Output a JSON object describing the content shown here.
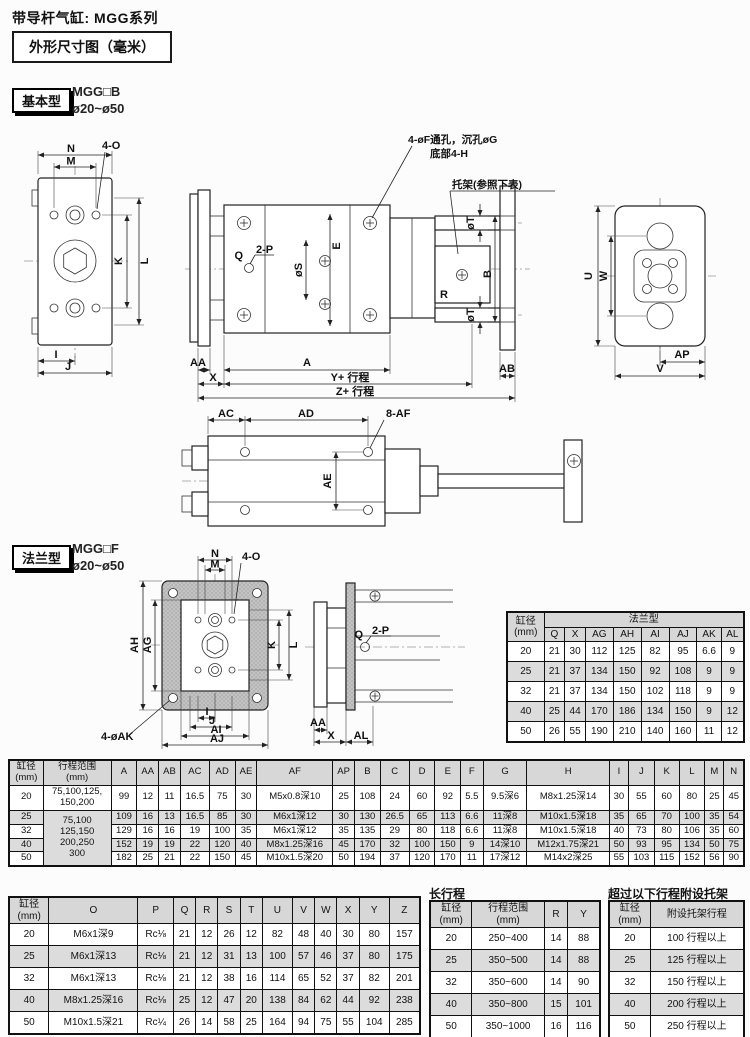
{
  "page": {
    "title": "带导杆气缸: MGG系列",
    "dim_box": "外形尺寸图（毫米）"
  },
  "basic": {
    "tag": "基本型",
    "model": "MGG□B",
    "bore": "ø20~ø50"
  },
  "flange": {
    "tag": "法兰型",
    "model": "MGG□F",
    "bore": "ø20~ø50"
  },
  "basic_labels": {
    "N": "N",
    "M": "M",
    "fourO": "4-O",
    "K": "K",
    "L": "L",
    "I": "I",
    "J": "J",
    "C": "C",
    "D": "D",
    "holeNote1": "4-øF通孔，沉孔øG",
    "holeNote2": "底部4-H",
    "bracketNote": "托架(参照下表)",
    "Q": "Q",
    "twoP": "2-P",
    "phiS": "øS",
    "E": "E",
    "phiT": "øT",
    "B": "B",
    "R": "R",
    "AA": "AA",
    "X": "X",
    "A": "A",
    "Ystroke": "Y+ 行程",
    "Zstroke": "Z+ 行程",
    "AB": "AB",
    "U": "U",
    "W": "W",
    "AP": "AP",
    "V": "V",
    "AC": "AC",
    "AD": "AD",
    "eightAF": "8-AF",
    "AE": "AE"
  },
  "flange_labels": {
    "N": "N",
    "M": "M",
    "fourO": "4-O",
    "AH": "AH",
    "AG": "AG",
    "K": "K",
    "L": "L",
    "I": "I",
    "J": "J",
    "AI": "AI",
    "AJ": "AJ",
    "fourAK": "4-øAK",
    "Q": "Q",
    "twoP": "2-P",
    "AA": "AA",
    "X": "X",
    "AL": "AL"
  },
  "flange_table": {
    "header_rows": [
      [
        {
          "text": "缸径\n(mm)",
          "rowspan": 2
        },
        {
          "text": "法兰型",
          "colspan": 8
        }
      ],
      [
        "Q",
        "X",
        "AG",
        "AH",
        "AI",
        "AJ",
        "AK",
        "AL"
      ]
    ],
    "rows": [
      [
        "20",
        "21",
        "30",
        "112",
        "125",
        "82",
        "95",
        "6.6",
        "9"
      ],
      [
        "25",
        "21",
        "37",
        "134",
        "150",
        "92",
        "108",
        "9",
        "9"
      ],
      [
        "32",
        "21",
        "37",
        "134",
        "150",
        "102",
        "118",
        "9",
        "9"
      ],
      [
        "40",
        "25",
        "44",
        "170",
        "186",
        "134",
        "150",
        "9",
        "12"
      ],
      [
        "50",
        "26",
        "55",
        "190",
        "210",
        "140",
        "160",
        "11",
        "12"
      ]
    ]
  },
  "main_table": {
    "header_rows": [
      [
        "缸径\n(mm)",
        "行程范围\n(mm)",
        "A",
        "AA",
        "AB",
        "AC",
        "AD",
        "AE",
        "AF",
        "AP",
        "B",
        "C",
        "D",
        "E",
        "F",
        "G",
        "H",
        "I",
        "J",
        "K",
        "L",
        "M",
        "N"
      ]
    ],
    "rows": [
      [
        "20",
        "75,100,125,\n150,200",
        "99",
        "12",
        "11",
        "16.5",
        "75",
        "30",
        "M5x0.8深10",
        "25",
        "108",
        "24",
        "60",
        "92",
        "5.5",
        "9.5深6",
        "M8x1.25深14",
        "30",
        "55",
        "60",
        "80",
        "25",
        "45"
      ],
      [
        "25",
        {
          "text": "75,100\n125,150\n200,250\n300",
          "rowspan": 4
        },
        "109",
        "16",
        "13",
        "16.5",
        "85",
        "30",
        "M6x1深12",
        "30",
        "130",
        "26.5",
        "65",
        "113",
        "6.6",
        "11深8",
        "M10x1.5深18",
        "35",
        "65",
        "70",
        "100",
        "35",
        "54"
      ],
      [
        "32",
        null,
        "129",
        "16",
        "16",
        "19",
        "100",
        "35",
        "M6x1深12",
        "35",
        "135",
        "29",
        "80",
        "118",
        "6.6",
        "11深8",
        "M10x1.5深18",
        "40",
        "73",
        "80",
        "106",
        "35",
        "60"
      ],
      [
        "40",
        null,
        "152",
        "19",
        "19",
        "22",
        "120",
        "40",
        "M8x1.25深16",
        "45",
        "170",
        "32",
        "100",
        "150",
        "9",
        "14深10",
        "M12x1.75深21",
        "50",
        "93",
        "95",
        "134",
        "50",
        "75"
      ],
      [
        "50",
        null,
        "182",
        "25",
        "21",
        "22",
        "150",
        "45",
        "M10x1.5深20",
        "50",
        "194",
        "37",
        "120",
        "170",
        "11",
        "17深12",
        "M14x2深25",
        "55",
        "103",
        "115",
        "152",
        "56",
        "90"
      ]
    ]
  },
  "dims_table": {
    "header_rows": [
      [
        "缸径\n(mm)",
        "O",
        "P",
        "Q",
        "R",
        "S",
        "T",
        "U",
        "V",
        "W",
        "X",
        "Y",
        "Z"
      ]
    ],
    "rows": [
      [
        "20",
        "M6x1深9",
        "Rc⅛",
        "21",
        "12",
        "26",
        "12",
        "82",
        "48",
        "40",
        "30",
        "80",
        "157"
      ],
      [
        "25",
        "M6x1深13",
        "Rc⅛",
        "21",
        "12",
        "31",
        "13",
        "100",
        "57",
        "46",
        "37",
        "80",
        "175"
      ],
      [
        "32",
        "M6x1深13",
        "Rc⅛",
        "21",
        "12",
        "38",
        "16",
        "114",
        "65",
        "52",
        "37",
        "82",
        "201"
      ],
      [
        "40",
        "M8x1.25深16",
        "Rc⅛",
        "25",
        "12",
        "47",
        "20",
        "138",
        "84",
        "62",
        "44",
        "92",
        "238"
      ],
      [
        "50",
        "M10x1.5深21",
        "Rc¼",
        "26",
        "14",
        "58",
        "25",
        "164",
        "94",
        "75",
        "55",
        "104",
        "285"
      ]
    ]
  },
  "long_stroke": {
    "title": "长行程",
    "header_rows": [
      [
        "缸径\n(mm)",
        "行程范围\n(mm)",
        "R",
        "Y"
      ]
    ],
    "rows": [
      [
        "20",
        "250~400",
        "14",
        "88"
      ],
      [
        "25",
        "350~500",
        "14",
        "88"
      ],
      [
        "32",
        "350~600",
        "14",
        "90"
      ],
      [
        "40",
        "350~800",
        "15",
        "101"
      ],
      [
        "50",
        "350~1000",
        "16",
        "116"
      ]
    ]
  },
  "bracket_table": {
    "title": "超过以下行程附设托架",
    "header_rows": [
      [
        "缸径\n(mm)",
        "附设托架行程"
      ]
    ],
    "rows": [
      [
        "20",
        "100 行程以上"
      ],
      [
        "25",
        "125 行程以上"
      ],
      [
        "32",
        "150 行程以上"
      ],
      [
        "40",
        "200 行程以上"
      ],
      [
        "50",
        "250 行程以上"
      ]
    ]
  }
}
